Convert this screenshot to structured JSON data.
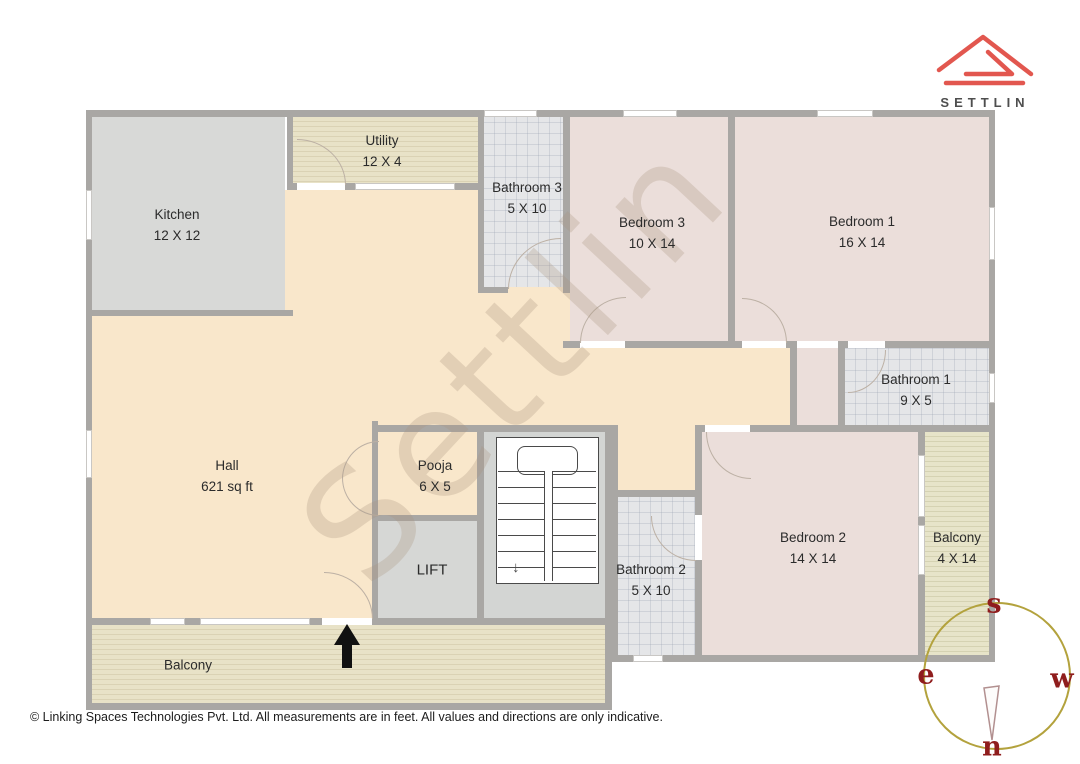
{
  "brand": {
    "name": "SETTLIN",
    "logo_color": "#e2574f",
    "text_color": "#4e4e4e"
  },
  "watermark": "Settlin",
  "rooms": {
    "kitchen": {
      "name": "Kitchen",
      "dims": "12 X 12"
    },
    "utility": {
      "name": "Utility",
      "dims": "12 X 4"
    },
    "bathroom3": {
      "name": "Bathroom 3",
      "dims": "5 X 10"
    },
    "bedroom3": {
      "name": "Bedroom 3",
      "dims": "10 X 14"
    },
    "bedroom1": {
      "name": "Bedroom 1",
      "dims": "16 X 14"
    },
    "bathroom1": {
      "name": "Bathroom 1",
      "dims": "9 X 5"
    },
    "hall": {
      "name": "Hall",
      "dims": "621 sq ft"
    },
    "pooja": {
      "name": "Pooja",
      "dims": "6 X 5"
    },
    "lift": {
      "name": "LIFT"
    },
    "bathroom2": {
      "name": "Bathroom 2",
      "dims": "5 X 10"
    },
    "bedroom2": {
      "name": "Bedroom 2",
      "dims": "14 X 14"
    },
    "balcony_right": {
      "name": "Balcony",
      "dims": "4 X 14"
    },
    "balcony_bottom": {
      "name": "Balcony"
    }
  },
  "compass": {
    "top": "s",
    "left": "e",
    "right": "w",
    "bottom": "n",
    "ring_color": "#b3a23d",
    "letter_color": "#8f1d1d"
  },
  "footer": {
    "copyright": "© Linking Spaces Technologies Pvt. Ltd. All measurements are in feet. All values and directions are only indicative."
  },
  "palette": {
    "wall": "#a9a7a4",
    "hall": "#f9e7cb",
    "bedroom": "#ebdeda",
    "bathroom": "#e5e6e8",
    "kitchen": "#d8d9d7",
    "balcony": "#e8e2c7"
  }
}
